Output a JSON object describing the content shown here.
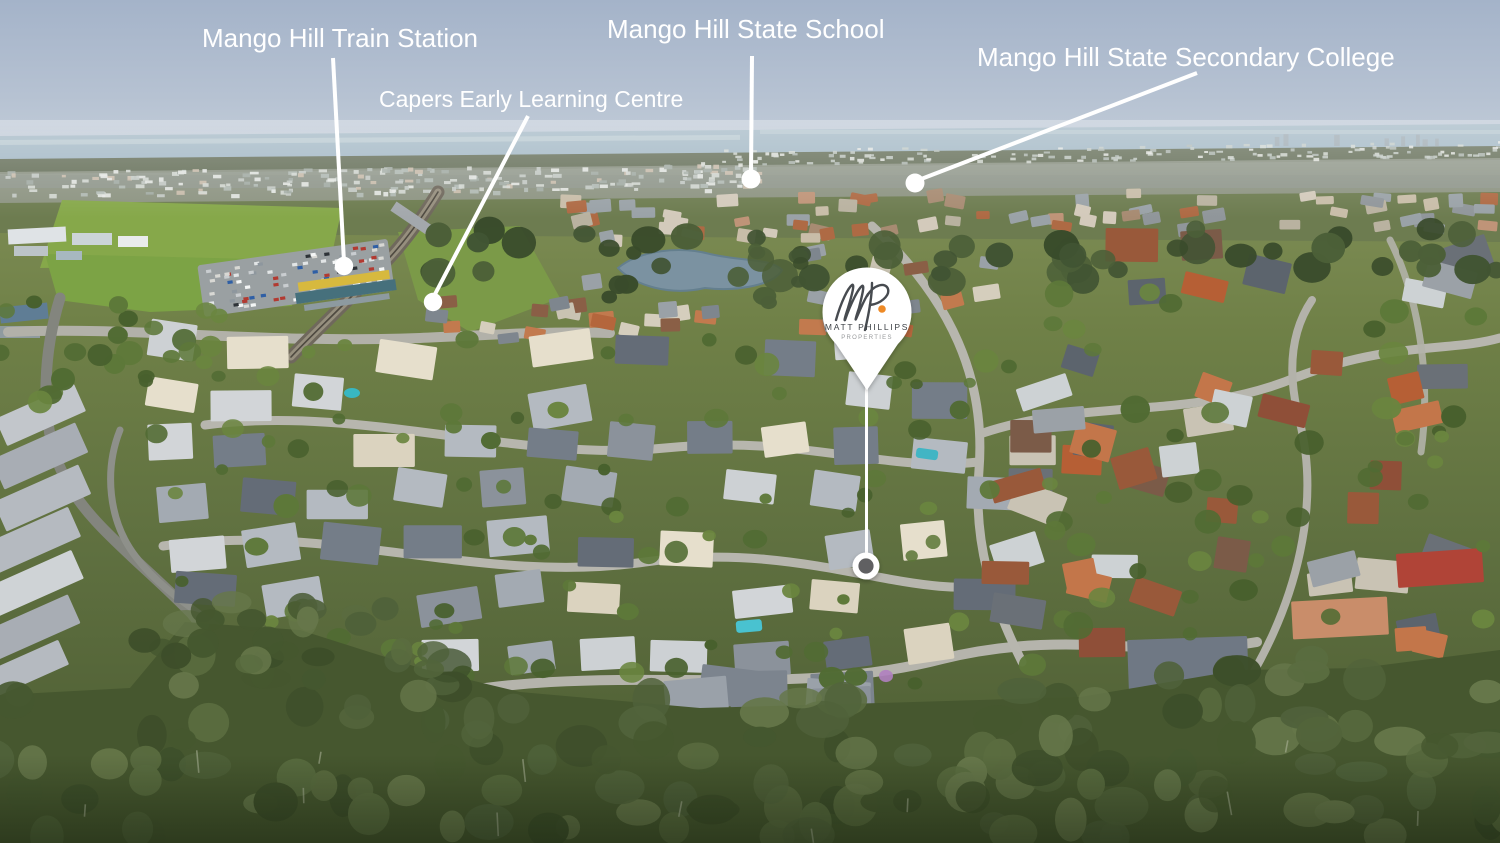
{
  "annotations": {
    "line_color": "#ffffff",
    "labels": [
      {
        "id": "train-station",
        "text": "Mango Hill Train Station"
      },
      {
        "id": "early-learning-centre",
        "text": "Capers Early Learning Centre"
      },
      {
        "id": "state-school",
        "text": "Mango Hill State School"
      },
      {
        "id": "secondary-college",
        "text": "Mango Hill State Secondary College"
      }
    ]
  },
  "badge": {
    "monogram": "MP",
    "name": "MATT PHILLIPS",
    "subtitle": "PROPERTIES"
  },
  "palette": {
    "annotation": "#ffffff",
    "brand_accent": "#ee8a26",
    "badge_text": "#3e4247",
    "badge_subtext": "#97999b",
    "marker_inner": "#606062"
  }
}
